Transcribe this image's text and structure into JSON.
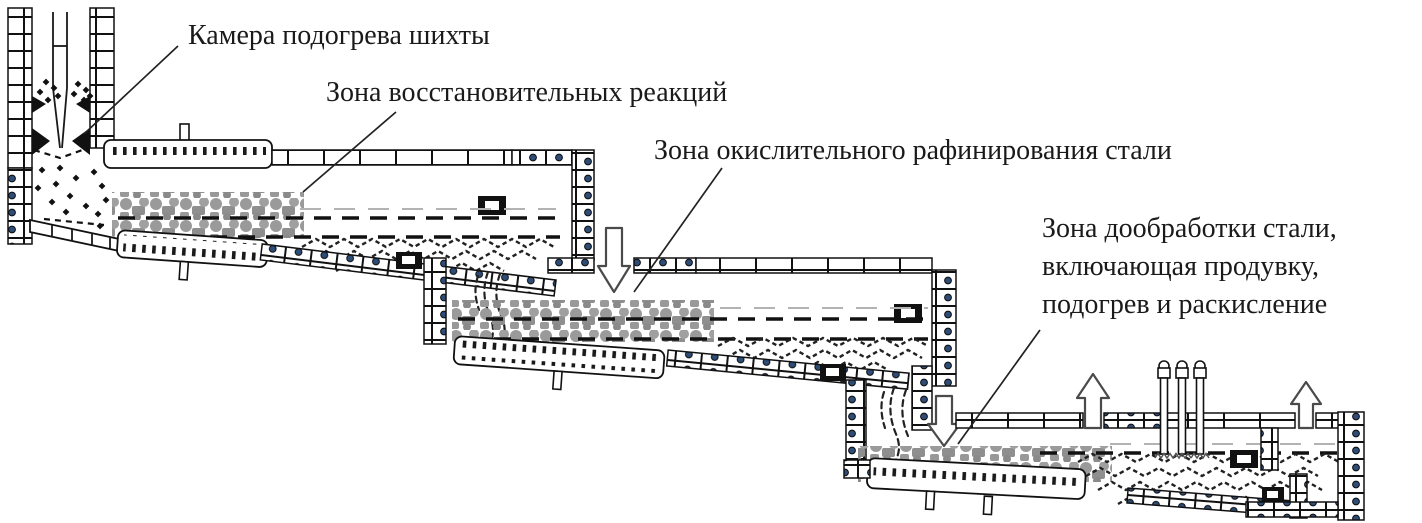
{
  "figure": {
    "type": "furnace-schematic",
    "subject": "Multi-zone continuous steelmaking unit, cascading hearths",
    "labels": {
      "preheat": "Камера подогрева шихты",
      "reduction": "Зона восстановительных реакций",
      "oxidation": "Зона окислительного рафинирования стали",
      "finishing_line1": "Зона дообработки стали,",
      "finishing_line2": "включающая продувку,",
      "finishing_line3": "подогрев и раскисление"
    },
    "colors": {
      "line": "#1a1a1a",
      "text": "#1a1a1a",
      "foam_gray": "#949494",
      "bolt_blue": "#2d4d78",
      "arrow_outline": "#4a4a4a",
      "background": "#ffffff"
    }
  }
}
